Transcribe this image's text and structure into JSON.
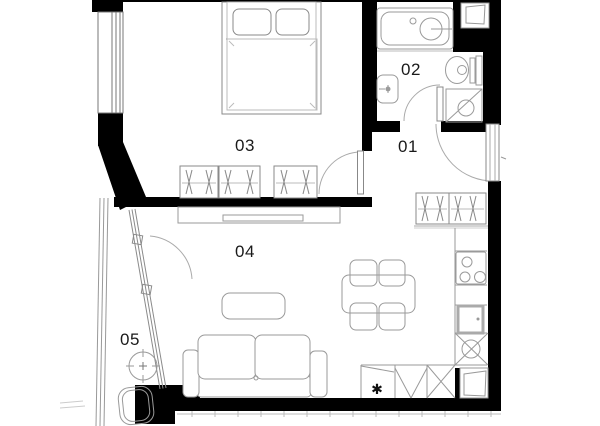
{
  "floor_plan": {
    "rooms": [
      {
        "label": "01"
      },
      {
        "label": "02"
      },
      {
        "label": "03"
      },
      {
        "label": "04"
      },
      {
        "label": "05"
      }
    ],
    "symbols": {
      "dishwasher_star": "✱"
    },
    "colors": {
      "wall": "#000000",
      "furniture_line": "#9a9a9a",
      "label_text": "#1a1a1a",
      "background": "#ffffff"
    }
  }
}
